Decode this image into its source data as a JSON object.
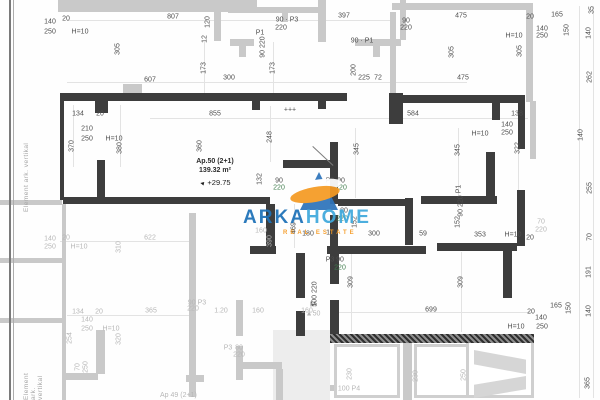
{
  "apartment": {
    "name": "Ap.50 (2+1)",
    "area": "139.32 m²",
    "elevation": "+29.75"
  },
  "below_apartment": {
    "name": "Ap 49 (2+1)"
  },
  "side_text": {
    "label": "Element ark. vertikal",
    "label_partial": "Element ark. vertikal"
  },
  "branding": {
    "arka": "ARKA",
    "home": "HOME",
    "tagline": "REAL ESTATE",
    "blue_dark": "#1d71b8",
    "blue_light": "#3fa9dc",
    "orange": "#f59a23"
  },
  "colors": {
    "wall_dark": "#3d3d3d",
    "wall_light": "#c9c9c9",
    "dim_dark": "#4e4e4e",
    "dim_light": "#b7b7b7",
    "dim_green": "#417e4e"
  },
  "plan": {
    "walls_dark": [
      [
        60,
        93,
        287,
        8
      ],
      [
        95,
        101,
        13,
        12
      ],
      [
        252,
        101,
        8,
        9
      ],
      [
        318,
        101,
        8,
        8
      ],
      [
        389,
        93,
        14,
        31
      ],
      [
        398,
        95,
        127,
        8
      ],
      [
        492,
        103,
        8,
        17
      ],
      [
        518,
        103,
        7,
        46
      ],
      [
        60,
        101,
        4,
        99
      ],
      [
        97,
        160,
        8,
        38
      ],
      [
        63,
        197,
        207,
        7
      ],
      [
        283,
        160,
        55,
        8
      ],
      [
        330,
        142,
        8,
        62
      ],
      [
        330,
        215,
        8,
        32
      ],
      [
        266,
        204,
        9,
        43
      ],
      [
        250,
        246,
        26,
        8
      ],
      [
        327,
        246,
        99,
        8
      ],
      [
        437,
        243,
        80,
        8
      ],
      [
        405,
        198,
        8,
        47
      ],
      [
        338,
        199,
        70,
        7
      ],
      [
        486,
        152,
        9,
        47
      ],
      [
        421,
        196,
        76,
        8
      ],
      [
        517,
        190,
        8,
        56
      ],
      [
        296,
        253,
        9,
        45
      ],
      [
        296,
        311,
        9,
        25
      ],
      [
        330,
        254,
        9,
        30
      ],
      [
        330,
        300,
        9,
        36
      ],
      [
        503,
        251,
        9,
        47
      ]
    ],
    "walls_hatch": [
      [
        330,
        334,
        204,
        9
      ]
    ],
    "walls_light": [
      [
        58,
        0,
        194,
        12
      ],
      [
        123,
        84,
        19,
        9
      ],
      [
        214,
        0,
        7,
        41
      ],
      [
        228,
        7,
        91,
        6
      ],
      [
        250,
        0,
        7,
        8
      ],
      [
        282,
        12,
        6,
        10
      ],
      [
        318,
        0,
        8,
        42
      ],
      [
        230,
        39,
        24,
        7
      ],
      [
        239,
        46,
        7,
        11
      ],
      [
        355,
        39,
        46,
        7
      ],
      [
        373,
        46,
        7,
        11
      ],
      [
        400,
        0,
        6,
        40
      ],
      [
        392,
        3,
        140,
        7
      ],
      [
        526,
        3,
        7,
        99
      ],
      [
        390,
        12,
        6,
        81
      ],
      [
        530,
        101,
        6,
        58
      ],
      [
        189,
        213,
        7,
        184
      ],
      [
        62,
        204,
        4,
        196
      ],
      [
        0,
        200,
        62,
        5
      ],
      [
        0,
        258,
        62,
        5
      ],
      [
        0,
        318,
        62,
        5
      ],
      [
        96,
        330,
        9,
        44
      ],
      [
        62,
        373,
        36,
        7
      ],
      [
        236,
        300,
        7,
        36
      ],
      [
        236,
        346,
        7,
        34
      ],
      [
        236,
        362,
        46,
        7
      ],
      [
        276,
        369,
        7,
        31
      ],
      [
        403,
        340,
        9,
        60
      ],
      [
        330,
        385,
        34,
        6
      ],
      [
        186,
        375,
        18,
        7
      ]
    ],
    "fills": [
      [
        273,
        330,
        57,
        70
      ]
    ],
    "balconies": [
      [
        334,
        344,
        66,
        54
      ],
      [
        414,
        344,
        60,
        54
      ],
      [
        466,
        340,
        68,
        58
      ]
    ],
    "stair_flights": [
      [
        474,
        350,
        52,
        24,
        "polygon(0 0,100% 40%,100% 100%,0 60%)"
      ],
      [
        474,
        376,
        52,
        22,
        "polygon(0 40%,100% 0,100% 60%,0 100%)"
      ]
    ],
    "dim_lines_h": [
      [
        67,
        20,
        325
      ],
      [
        67,
        82,
        400
      ],
      [
        150,
        118,
        378
      ],
      [
        60,
        241,
        130
      ],
      [
        67,
        315,
        122
      ],
      [
        335,
        312,
        198
      ]
    ],
    "dim_lines_v": [
      [
        73,
        105,
        62
      ],
      [
        120,
        105,
        62
      ],
      [
        204,
        42,
        52
      ],
      [
        273,
        42,
        52
      ],
      [
        270,
        106,
        56
      ],
      [
        294,
        204,
        44
      ],
      [
        355,
        128,
        70
      ],
      [
        458,
        128,
        70
      ],
      [
        518,
        128,
        70
      ],
      [
        351,
        252,
        80
      ],
      [
        461,
        252,
        80
      ],
      [
        579,
        6,
        392
      ],
      [
        593,
        6,
        392
      ]
    ],
    "doors": [
      [
        313,
        146,
        28,
        43
      ]
    ],
    "dim_labels": [
      [
        "140",
        50,
        22
      ],
      [
        "250",
        50,
        32
      ],
      [
        "20",
        66,
        19
      ],
      [
        "H=10",
        80,
        32
      ],
      [
        "807",
        173,
        17
      ],
      [
        "305",
        118,
        49,
        1
      ],
      [
        "607",
        150,
        80
      ],
      [
        "120",
        208,
        22,
        1
      ],
      [
        "12",
        205,
        39,
        1
      ],
      [
        "P1",
        260,
        33
      ],
      [
        "90 220",
        263,
        47,
        1
      ],
      [
        "90 · P3",
        287,
        20
      ],
      [
        "220",
        281,
        28
      ],
      [
        "397",
        344,
        16
      ],
      [
        "90 · P1",
        362,
        41
      ],
      [
        "173",
        204,
        68,
        1
      ],
      [
        "173",
        273,
        68,
        1
      ],
      [
        "200",
        354,
        70,
        1
      ],
      [
        "300",
        229,
        78
      ],
      [
        "225",
        364,
        78
      ],
      [
        "72",
        378,
        78
      ],
      [
        "475",
        461,
        16
      ],
      [
        "20",
        530,
        17
      ],
      [
        "165",
        557,
        15
      ],
      [
        "90",
        406,
        21
      ],
      [
        "220",
        406,
        28
      ],
      [
        "140",
        542,
        29
      ],
      [
        "250",
        542,
        36
      ],
      [
        "H=10",
        514,
        36
      ],
      [
        "150",
        567,
        30,
        1
      ],
      [
        "35",
        592,
        10,
        1
      ],
      [
        "140",
        589,
        33,
        1
      ],
      [
        "305",
        452,
        52,
        1
      ],
      [
        "305",
        520,
        51,
        1
      ],
      [
        "262",
        590,
        77,
        1
      ],
      [
        "475",
        463,
        78
      ],
      [
        "855",
        215,
        114
      ],
      [
        "+++",
        290,
        110
      ],
      [
        "584",
        413,
        114
      ],
      [
        "138",
        517,
        114
      ],
      [
        "134",
        78,
        114
      ],
      [
        "20",
        100,
        114
      ],
      [
        "210",
        87,
        129
      ],
      [
        "250",
        87,
        139
      ],
      [
        "H=10",
        114,
        139
      ],
      [
        "370",
        72,
        146,
        1
      ],
      [
        "380",
        120,
        148,
        1
      ],
      [
        "360",
        200,
        146,
        1
      ],
      [
        "248",
        270,
        137,
        1
      ],
      [
        "345",
        357,
        149,
        1
      ],
      [
        "345",
        458,
        150,
        1
      ],
      [
        "322",
        518,
        148,
        1
      ],
      [
        "140",
        507,
        125
      ],
      [
        "250",
        507,
        133
      ],
      [
        "H=10",
        480,
        134
      ],
      [
        "140",
        581,
        135,
        1
      ],
      [
        "132",
        260,
        179,
        1
      ],
      [
        "90",
        279,
        181
      ],
      [
        "220",
        279,
        188,
        0,
        "n"
      ],
      [
        "P3",
        330,
        181
      ],
      [
        "90",
        341,
        181
      ],
      [
        "220",
        341,
        188,
        0,
        "n"
      ],
      [
        "P1",
        459,
        189,
        1
      ],
      [
        "90 220",
        461,
        206,
        1
      ],
      [
        "152",
        355,
        222,
        1
      ],
      [
        "152",
        458,
        222,
        1
      ],
      [
        "80",
        344,
        211
      ],
      [
        "220",
        342,
        219,
        0,
        "n"
      ],
      [
        "469",
        294,
        228,
        1
      ],
      [
        "160",
        261,
        231,
        0,
        "g"
      ],
      [
        "390",
        270,
        241,
        1,
        "g"
      ],
      [
        "180",
        308,
        234
      ],
      [
        "12",
        330,
        233
      ],
      [
        "300",
        374,
        234
      ],
      [
        "59",
        423,
        234
      ],
      [
        "353",
        480,
        235
      ],
      [
        "H=10",
        513,
        235
      ],
      [
        "20",
        530,
        238
      ],
      [
        "70",
        541,
        222,
        0,
        "g"
      ],
      [
        "220",
        541,
        230,
        0,
        "g"
      ],
      [
        "255",
        590,
        188,
        1
      ],
      [
        "70",
        590,
        237,
        1
      ],
      [
        "191",
        589,
        272,
        1
      ],
      [
        "P3",
        330,
        260
      ],
      [
        "90",
        340,
        260
      ],
      [
        "220",
        340,
        268,
        0,
        "n"
      ],
      [
        "100 220",
        315,
        294,
        1
      ],
      [
        "M",
        313,
        305
      ],
      [
        "309",
        351,
        282,
        1
      ],
      [
        "309",
        461,
        282,
        1
      ],
      [
        "699",
        431,
        310
      ],
      [
        "140",
        50,
        239,
        0,
        "g"
      ],
      [
        "250",
        50,
        247,
        0,
        "g"
      ],
      [
        "20",
        66,
        238,
        0,
        "g"
      ],
      [
        "H=10",
        79,
        247,
        0,
        "g"
      ],
      [
        "622",
        150,
        238,
        0,
        "g"
      ],
      [
        "310",
        119,
        247,
        1,
        "g"
      ],
      [
        "134",
        78,
        312,
        0,
        "g"
      ],
      [
        "20",
        99,
        312,
        0,
        "g"
      ],
      [
        "365",
        151,
        311,
        0,
        "g"
      ],
      [
        "140",
        87,
        320,
        0,
        "g"
      ],
      [
        "250",
        87,
        329,
        0,
        "g"
      ],
      [
        "H=10",
        111,
        329,
        0,
        "g"
      ],
      [
        "254",
        70,
        338,
        1,
        "g"
      ],
      [
        "320",
        119,
        339,
        1,
        "g"
      ],
      [
        "70",
        78,
        367,
        1,
        "g"
      ],
      [
        "250",
        86,
        367,
        1,
        "g"
      ],
      [
        "90 P3",
        197,
        303,
        0,
        "g"
      ],
      [
        "220",
        193,
        309,
        0,
        "g"
      ],
      [
        "1.20",
        221,
        311,
        0,
        "g"
      ],
      [
        "160",
        258,
        311,
        0,
        "g"
      ],
      [
        "160",
        307,
        311,
        0,
        "g"
      ],
      [
        "P3",
        228,
        348,
        0,
        "g"
      ],
      [
        "80",
        239,
        348,
        0,
        "g"
      ],
      [
        "220",
        239,
        355,
        0,
        "g"
      ],
      [
        "▲50",
        313,
        314,
        0,
        "g"
      ],
      [
        "230",
        350,
        374,
        1,
        "g"
      ],
      [
        "230",
        416,
        376,
        1,
        "g"
      ],
      [
        "250",
        464,
        375,
        1,
        "g"
      ],
      [
        "100 P4",
        349,
        389,
        0,
        "g"
      ],
      [
        "20",
        531,
        312
      ],
      [
        "165",
        556,
        306
      ],
      [
        "150",
        569,
        308,
        1
      ],
      [
        "140",
        541,
        318
      ],
      [
        "250",
        542,
        327
      ],
      [
        "H=10",
        516,
        327
      ],
      [
        "140",
        589,
        311,
        1
      ],
      [
        "365",
        588,
        383,
        1
      ]
    ]
  }
}
